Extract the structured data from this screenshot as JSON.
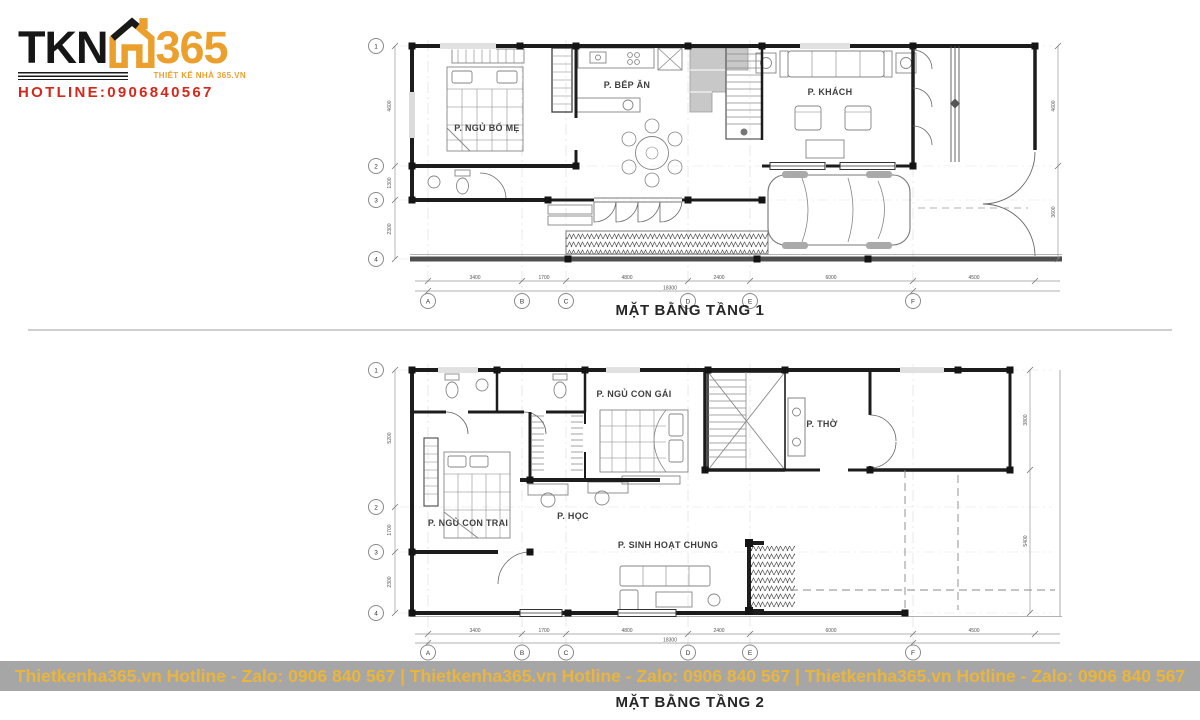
{
  "logo": {
    "brand_prefix": "TKN",
    "brand_number": "365",
    "tagline": "THIẾT KẾ NHÀ 365.VN",
    "hotline": "HOTLINE:0906840567"
  },
  "grid": {
    "rows": [
      "1",
      "2",
      "3",
      "4"
    ],
    "cols": [
      "A",
      "B",
      "C",
      "D",
      "E",
      "F"
    ]
  },
  "floor1": {
    "title": "MẶT BẰNG TẦNG 1",
    "rooms": {
      "parents_bedroom": "P. NGỦ BỐ MẸ",
      "kitchen_dining": "P. BẾP ĂN",
      "living_room": "P. KHÁCH"
    },
    "dims_bottom": [
      "3400",
      "1700",
      "4800",
      "2400",
      "6000",
      "4500"
    ],
    "dim_total": "18300",
    "dims_left": [
      "4600",
      "1300",
      "2300"
    ],
    "dims_right": [
      "4600",
      "3600"
    ]
  },
  "floor2": {
    "title": "MẶT BẰNG TẦNG 2",
    "rooms": {
      "daughter_bedroom": "P. NGỦ CON GÁI",
      "son_bedroom": "P. NGỦ CON TRAI",
      "study_room": "P. HỌC",
      "family_room": "P. SINH HOẠT CHUNG",
      "worship_room": "P. THỜ"
    },
    "dims_bottom": [
      "3400",
      "1700",
      "4800",
      "2400",
      "6000",
      "4500"
    ],
    "dim_total": "18300",
    "dims_left": [
      "5200",
      "1700",
      "2300"
    ],
    "dims_right": [
      "3800",
      "5400"
    ]
  },
  "banner": {
    "text": "Thietkenha365.vn Hotline - Zalo: 0906 840 567 | Thietkenha365.vn Hotline - Zalo: 0906 840 567 | Thietkenha365.vn Hotline - Zalo: 0906 840 567"
  },
  "colors": {
    "brand_orange": "#eb9f2c",
    "hotline_red": "#d5281c",
    "banner_text": "#e9b53c",
    "banner_bg": "#a09ea0",
    "wall": "#1c1c1c"
  }
}
